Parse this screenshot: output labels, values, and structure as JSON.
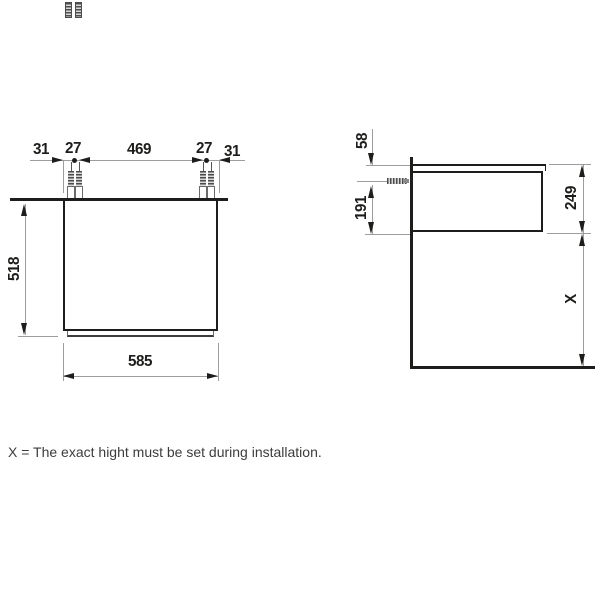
{
  "front_view": {
    "top_dims": [
      "31",
      "27",
      "469",
      "27",
      "31"
    ],
    "height_dim": "518",
    "width_dim": "585"
  },
  "side_view": {
    "worktop_to_screw_dim": "58",
    "screw_to_bottom_dim": "191",
    "cabinet_height_dim": "249",
    "install_height_dim": "X"
  },
  "caption": "X = The exact hight must be set during installation.",
  "colors": {
    "line": "#1d1d1b",
    "extension_line": "#9d9d9c",
    "caption_text": "#3c3c3b",
    "background": "#ffffff"
  }
}
